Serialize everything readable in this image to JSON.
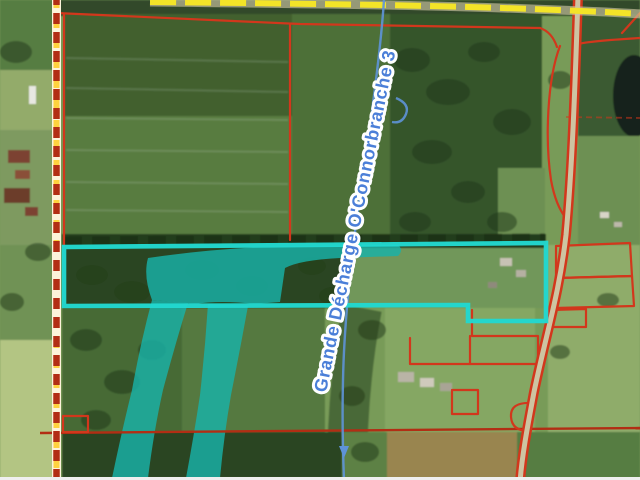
{
  "map": {
    "watercourse_label": "Grande Décharge O'Connorbranche 3",
    "features": [
      "municipal-boundary-line",
      "yellow-road",
      "county-road",
      "property-boundary-lines",
      "highlighted-parcel-outline",
      "wetland-overlay",
      "stream-line",
      "watercourse-label"
    ]
  },
  "colors": {
    "parcel-highlight": "#22d8cf",
    "wetland": "#18b2a8",
    "boundary": "#d2371c",
    "boundary-dark": "#b22e14",
    "road-yellow": "#f3e428",
    "road-surface": "#cdc4a2",
    "muni-yellow": "#ffd23e",
    "muni-base": "#fcf3da",
    "stream": "#5e93d8",
    "label-text": "#4b7fd8",
    "label-halo": "#ffffff"
  }
}
